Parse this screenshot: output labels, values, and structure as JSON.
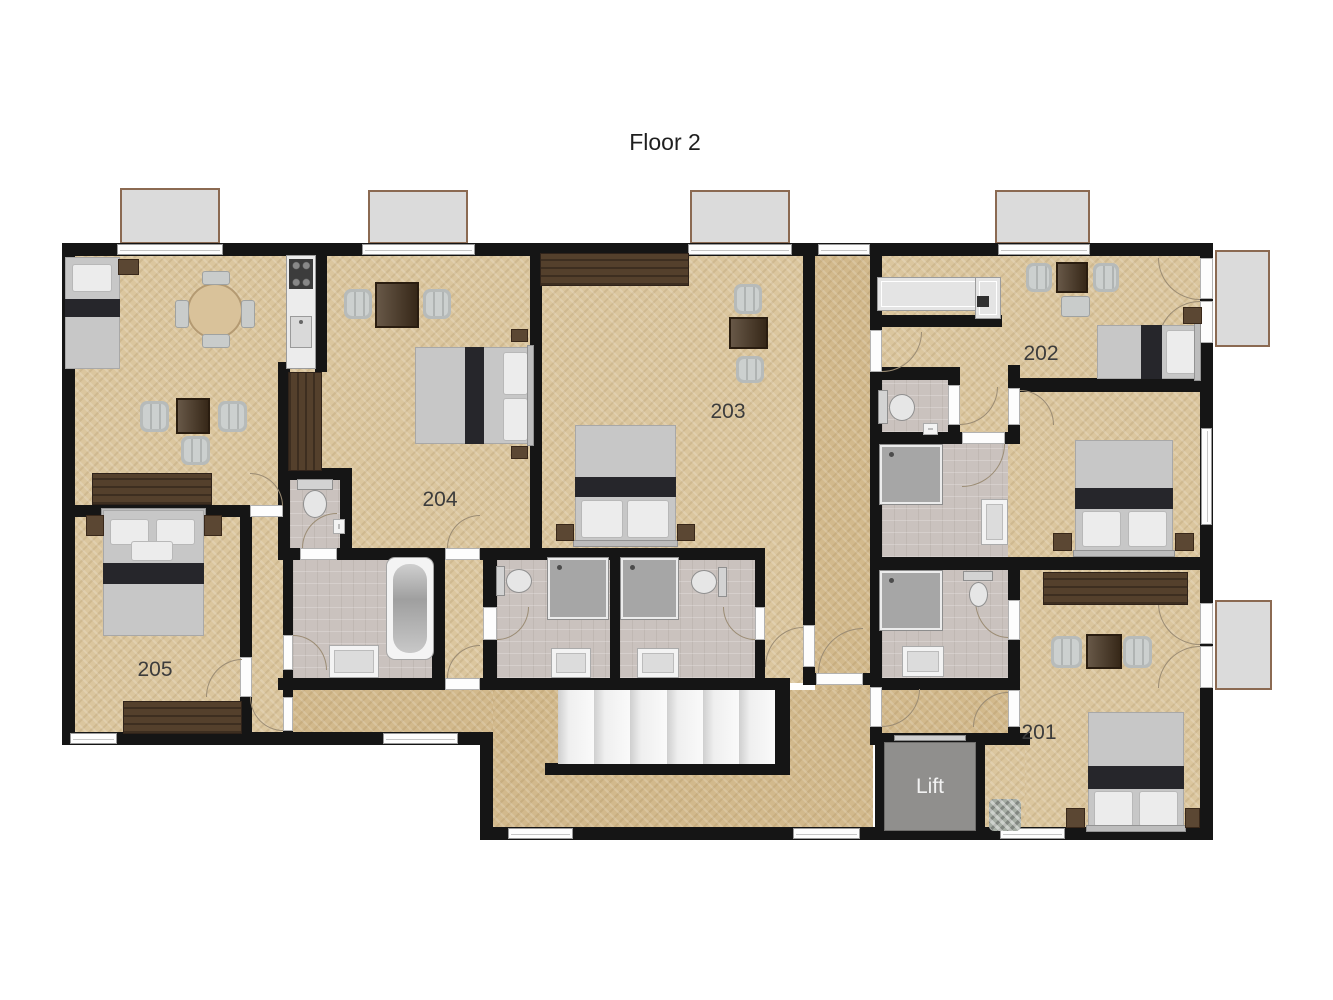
{
  "title": "Floor 2",
  "labels": {
    "lift": "Lift"
  },
  "rooms": [
    {
      "id": "201",
      "label": "201",
      "furniture": [
        "double-bed",
        "nightstands",
        "sideboard",
        "two-armchairs",
        "coffee-table",
        "luggage-basket",
        "balcony-french-doors",
        "ensuite-shower-room-with-toilet-and-sink"
      ]
    },
    {
      "id": "202",
      "label": "202",
      "furniture": [
        "kitchen-counter",
        "dining-table-with-chairs",
        "single-bed",
        "nightstand",
        "double-bed-room",
        "wc",
        "shower-room",
        "balcony-french-doors"
      ]
    },
    {
      "id": "203",
      "label": "203",
      "furniture": [
        "wardrobe",
        "two-armchairs",
        "side-table",
        "double-bed",
        "nightstands"
      ]
    },
    {
      "id": "204",
      "label": "204",
      "furniture": [
        "two-armchairs",
        "side-table",
        "double-bed",
        "nightstands"
      ]
    },
    {
      "id": "205",
      "label": "205",
      "furniture": [
        "double-bed",
        "nightstands",
        "sideboard"
      ]
    }
  ],
  "shared_spaces": [
    "corridor",
    "staircase",
    "lift",
    "living-room-with-kitchenette",
    "bathroom-with-bathtub",
    "wc",
    "two-shower-rooms"
  ],
  "colors": {
    "room_floor": "#dbc69e",
    "corridor_floor": "#d2b98c",
    "bathroom_floor": "#cac2be",
    "wall": "#151515",
    "wood_furniture": "#54402c",
    "balcony": "#dbdbdb",
    "balcony_border": "#8b6a52",
    "label_text": "#3c3c3c",
    "lift_text": "#f2f2f2"
  }
}
